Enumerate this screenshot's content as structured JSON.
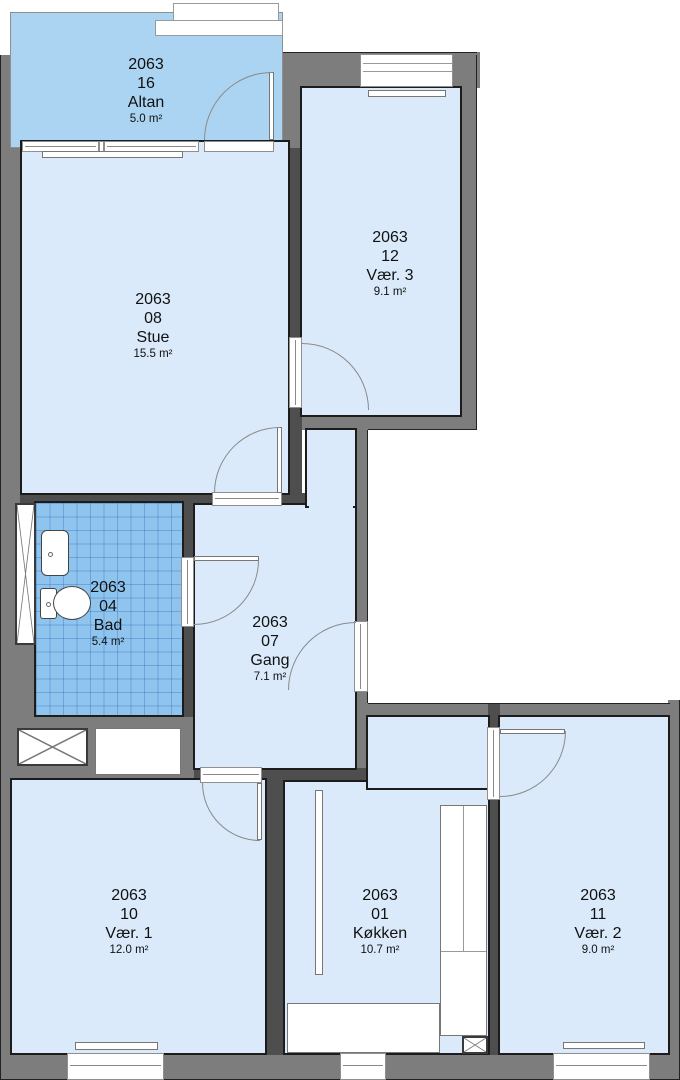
{
  "floor_plan": {
    "building_id": "2063",
    "rooms": [
      {
        "id": "2063",
        "unit": "16",
        "name": "Altan",
        "area": "5.0 m²"
      },
      {
        "id": "2063",
        "unit": "08",
        "name": "Stue",
        "area": "15.5 m²"
      },
      {
        "id": "2063",
        "unit": "12",
        "name": "Vær. 3",
        "area": "9.1 m²"
      },
      {
        "id": "2063",
        "unit": "04",
        "name": "Bad",
        "area": "5.4 m²"
      },
      {
        "id": "2063",
        "unit": "07",
        "name": "Gang",
        "area": "7.1 m²"
      },
      {
        "id": "2063",
        "unit": "10",
        "name": "Vær. 1",
        "area": "12.0 m²"
      },
      {
        "id": "2063",
        "unit": "01",
        "name": "Køkken",
        "area": "10.7 m²"
      },
      {
        "id": "2063",
        "unit": "11",
        "name": "Vær. 2",
        "area": "9.0 m²"
      }
    ],
    "colors": {
      "room_fill": "#daeafa",
      "balcony_fill": "#aad4f2",
      "bathroom_tile": "#8ec4ee",
      "exterior_wall": "#7d7d7d",
      "interior_wall": "#4e4e4e",
      "outline": "#1c1c1c"
    }
  }
}
